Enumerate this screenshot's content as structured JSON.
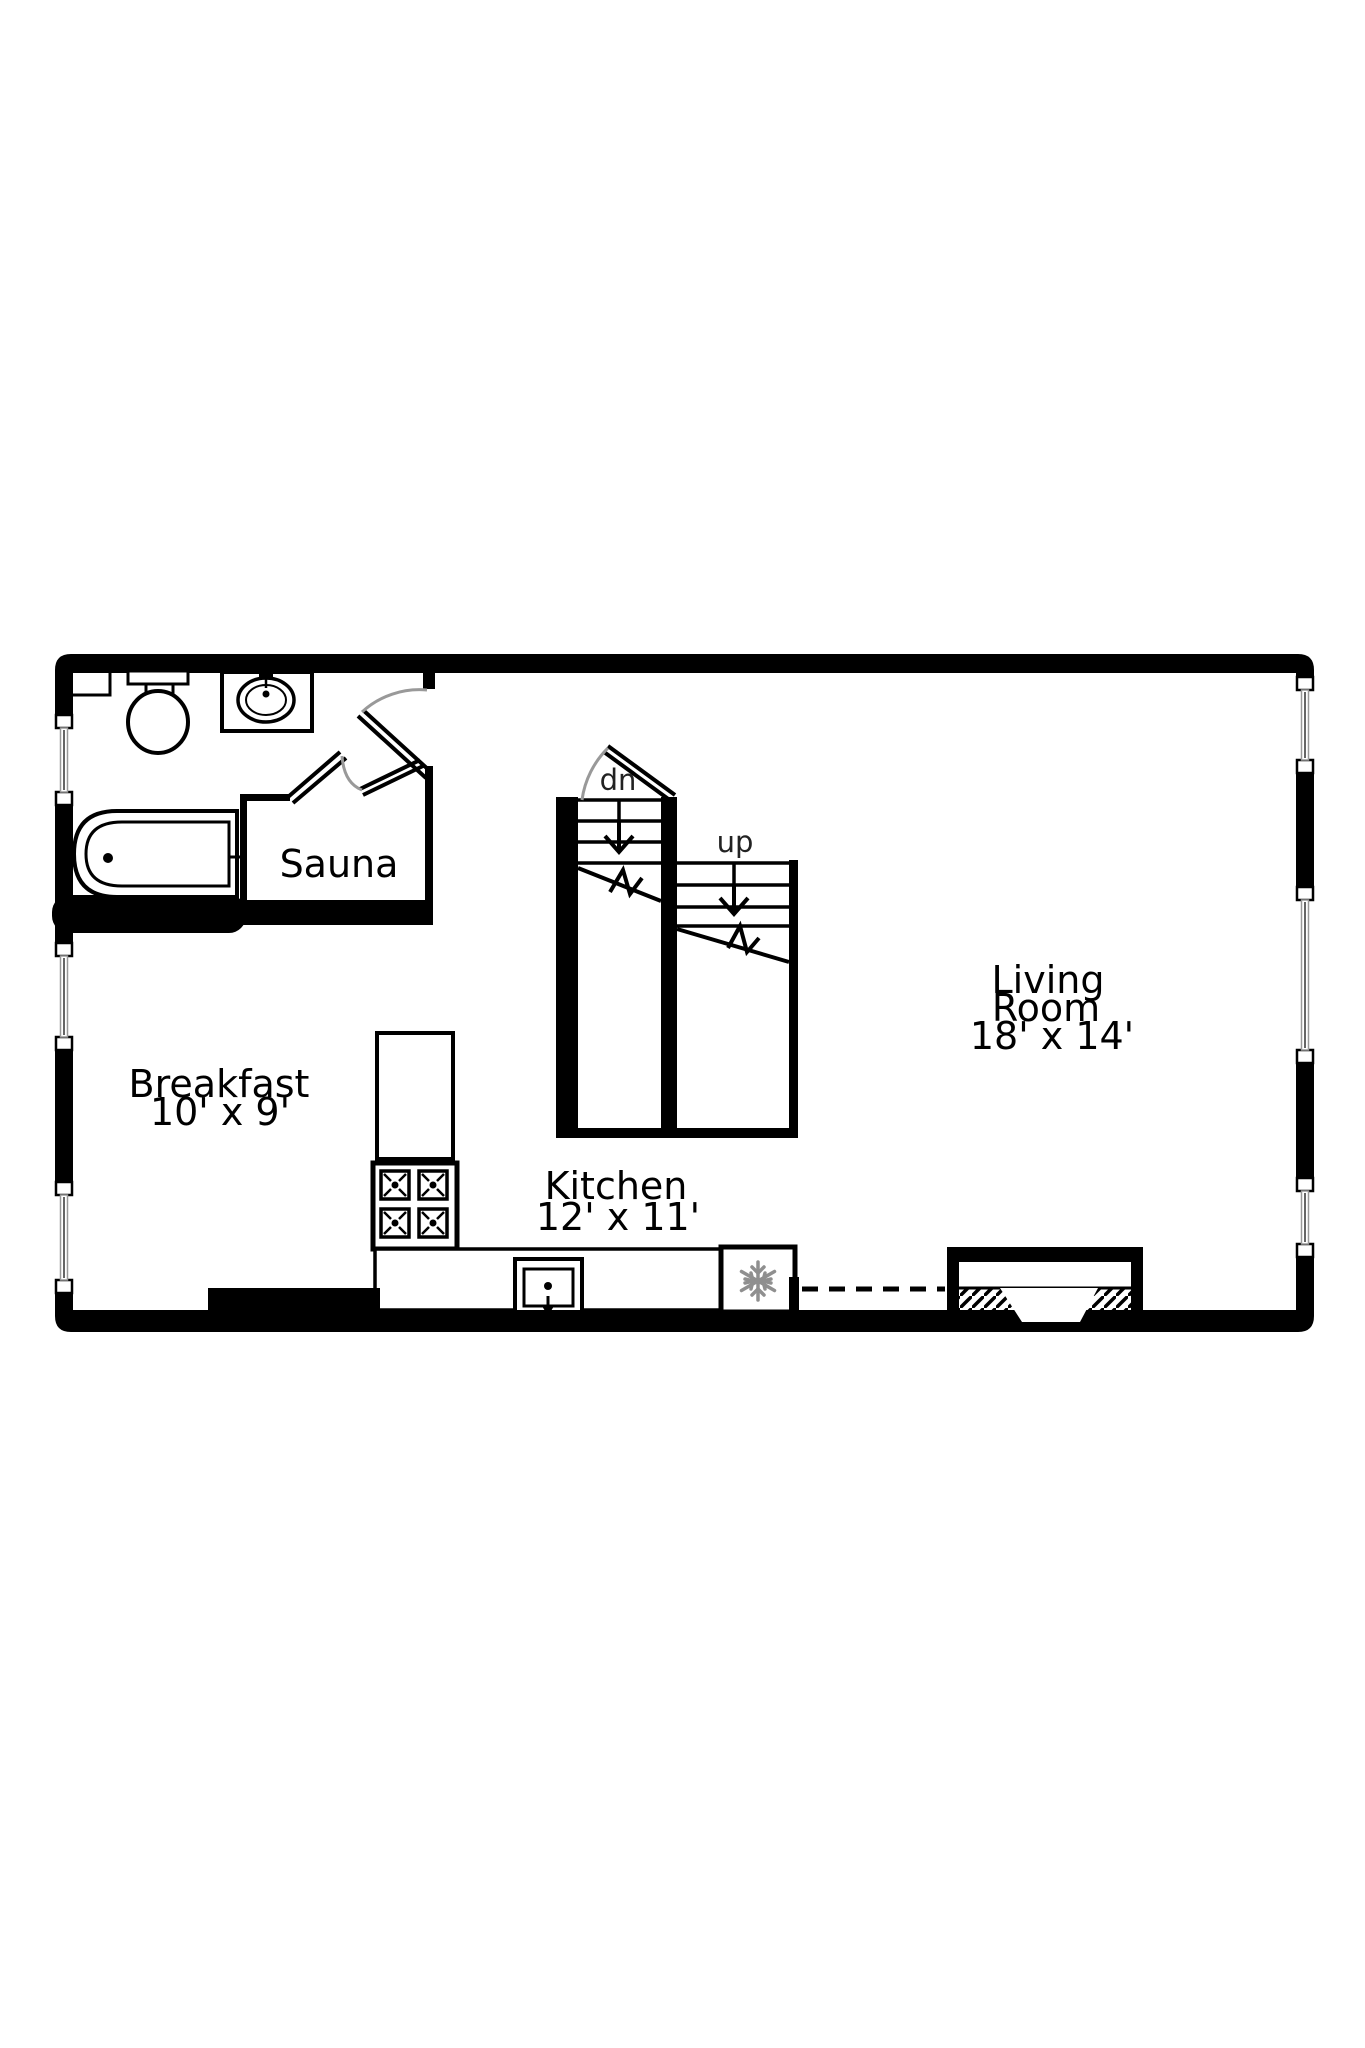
{
  "plan": {
    "rooms": {
      "sauna": {
        "label": "Sauna"
      },
      "breakfast": {
        "label": "Breakfast",
        "dims": "10' x 9'"
      },
      "kitchen": {
        "label": "Kitchen",
        "dims": "12' x 11'"
      },
      "living_room": {
        "line1": "Living",
        "line2": "Room",
        "dims": "18' x 14'"
      }
    },
    "stairs": {
      "down_label": "dn",
      "up_label": "up"
    },
    "colors": {
      "wall": "#000000",
      "background": "#ffffff",
      "door_arc": "#999999",
      "snowflake": "#8f8f8f",
      "label_text": "#000000",
      "stair_label_text": "#222222"
    }
  }
}
